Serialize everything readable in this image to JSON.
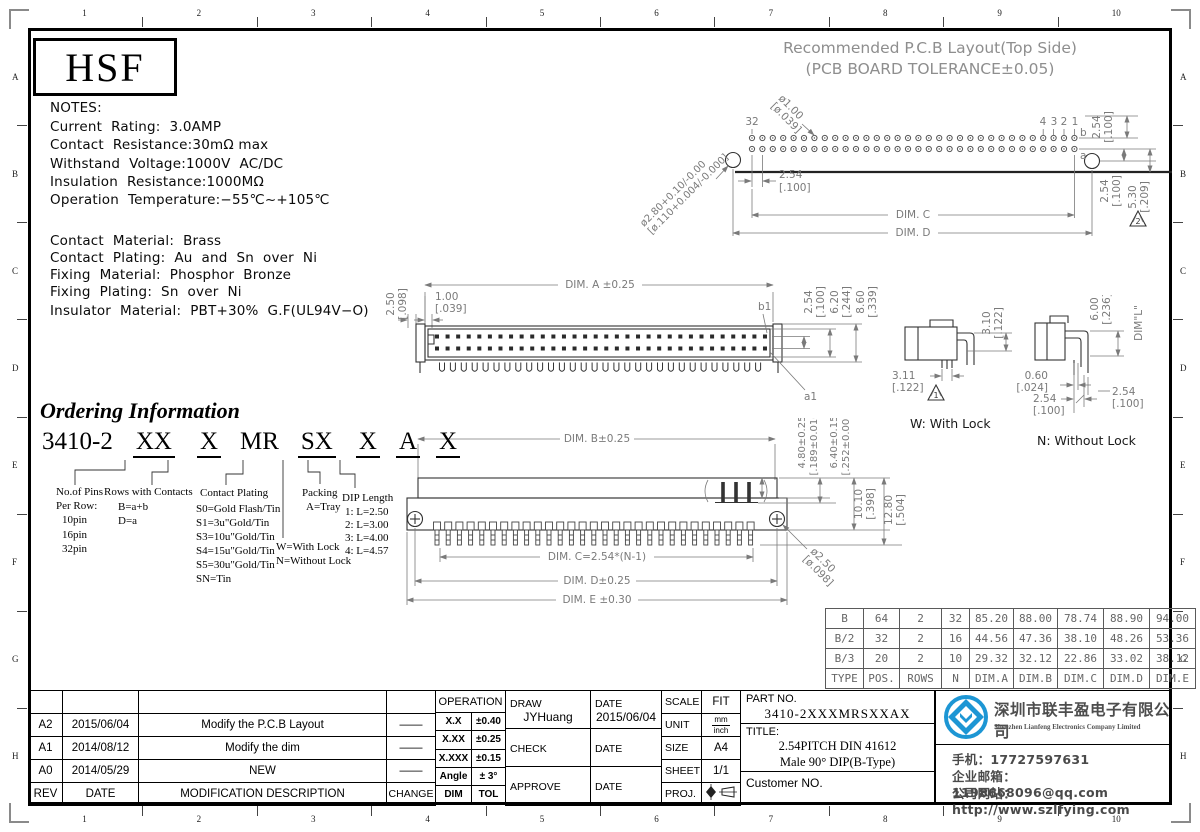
{
  "frame": {
    "cols": [
      "1",
      "2",
      "3",
      "4",
      "5",
      "6",
      "7",
      "8",
      "9",
      "10"
    ],
    "rows": [
      "A",
      "B",
      "C",
      "D",
      "E",
      "F",
      "G",
      "H"
    ]
  },
  "logo": {
    "text": "HSF"
  },
  "notes": {
    "title": "NOTES:",
    "lines": [
      "Current  Rating:  3.0AMP",
      "Contact  Resistance:30mΩ max",
      "Withstand  Voltage:1000V  AC/DC",
      "Insulation  Resistance:1000MΩ",
      "Operation  Temperature:−55℃~+105℃"
    ]
  },
  "materials": {
    "lines": [
      "Contact  Material:  Brass",
      "Contact  Plating:  Au  and  Sn  over  Ni",
      "Fixing  Material:  Phosphor  Bronze",
      "Fixing  Plating:  Sn  over  Ni",
      "Insulator  Material:  PBT+30%  G.F(UL94V−O)"
    ]
  },
  "pcb": {
    "title1": "Recommended  P.C.B  Layout(Top Side)",
    "title2": "(PCB  BOARD  TOLERANCE±0.05)",
    "pin32": "32",
    "pin4": "4",
    "pin3": "3",
    "pin2": "2",
    "pin1": "1",
    "row_b": "b",
    "row_a": "a",
    "hole1": "ø1.00",
    "hole1_in": "[ø.039]",
    "hole2": "ø2.80+0.10/-0.00",
    "hole2_in": "[ø.110+0.004/-0.000]",
    "pitch": "2.54",
    "pitch_in": "[.100]",
    "dim_c": "DIM. C",
    "dim_d": "DIM. D",
    "v1": "2.54",
    "v1_in": "[.100]",
    "v2": "2.54",
    "v2_in": "[.100]",
    "v3": "5.30",
    "v3_in": "[.209]",
    "tri": "2"
  },
  "front": {
    "d1": "2.50",
    "d1_in": "[.098]",
    "d2": "1.00",
    "d2_in": "[.039]",
    "dim_a": "DIM. A ±0.25",
    "b1": "b1",
    "a1": "a1",
    "v1": "2.54",
    "v1_in": "[.100]",
    "v2": "6.20",
    "v2_in": "[.244]",
    "v3": "8.60",
    "v3_in": "[.339]"
  },
  "lock_w": {
    "d1": "3.10",
    "d1_in": "[.122]",
    "d2": "3.11",
    "d2_in": "[.122]",
    "tri": "1",
    "caption": "W: With Lock"
  },
  "lock_n": {
    "d1": "6.00",
    "d1_in": "[.236]",
    "dim_l": "DIM\"L\"",
    "d2": "0.60",
    "d2_in": "[.024]",
    "d3": "2.54",
    "d3_in": "[.100]",
    "d4": "2.54",
    "d4_in": "[.100]",
    "caption": "N: Without Lock"
  },
  "bottom": {
    "dim_b": "DIM. B±0.25",
    "d1": "4.80±0.25",
    "d1_in": "[.189±0.010]",
    "d2": "6.40±0.15",
    "d2_in": "[.252±0.006]",
    "d3": "10.10",
    "d3_in": "[.398]",
    "d4": "12.80",
    "d4_in": "[.504]",
    "dim_c": "DIM. C=2.54*(N-1)",
    "dim_d": "DIM. D±0.25",
    "dim_e": "DIM. E ±0.30",
    "hole": "ø2.50",
    "hole_in": "[ø.098]"
  },
  "ordering": {
    "heading": "Ordering Information",
    "base": "3410-2",
    "codes": [
      "XX",
      "X",
      "MR",
      "SX",
      "X",
      "A",
      "X"
    ],
    "pins_title": "No.of Pins",
    "pins_sub": "Per Row:",
    "pins": [
      "10pin",
      "16pin",
      "32pin"
    ],
    "rows_title": "Rows with Contacts",
    "rows": [
      "B=a+b",
      "D=a"
    ],
    "plating_title": "Contact Plating",
    "plating": [
      "S0=Gold Flash/Tin",
      "S1=3u\"Gold/Tin",
      "S3=10u\"Gold/Tin",
      "S4=15u\"Gold/Tin",
      "S5=30u\"Gold/Tin",
      "SN=Tin"
    ],
    "lock": [
      "W=With Lock",
      "N=Without Lock"
    ],
    "packing_title": "Packing",
    "packing": "A=Tray",
    "dip_title": "DIP Length",
    "dip": [
      "1: L=2.50",
      "2: L=3.00",
      "3: L=4.00",
      "4: L=4.57"
    ]
  },
  "spec_table": {
    "rows": [
      [
        "B",
        "64",
        "2",
        "32",
        "85.20",
        "88.00",
        "78.74",
        "88.90",
        "94.00"
      ],
      [
        "B/2",
        "32",
        "2",
        "16",
        "44.56",
        "47.36",
        "38.10",
        "48.26",
        "53.36"
      ],
      [
        "B/3",
        "20",
        "2",
        "10",
        "29.32",
        "32.12",
        "22.86",
        "33.02",
        "38.12"
      ],
      [
        "TYPE",
        "POS.",
        "ROWS",
        "N",
        "DIM.A",
        "DIM.B",
        "DIM.C",
        "DIM.D",
        "DIM.E"
      ]
    ]
  },
  "rev_table": {
    "rows": [
      [
        "A2",
        "2015/06/04",
        "Modify the P.C.B Layout",
        "——"
      ],
      [
        "A1",
        "2014/08/12",
        "Modify the dim",
        "——"
      ],
      [
        "A0",
        "2014/05/29",
        "NEW",
        "——"
      ]
    ],
    "footer": [
      "REV",
      "DATE",
      "MODIFICATION DESCRIPTION",
      "CHANGE"
    ]
  },
  "tol_table": {
    "header": "OPERATION",
    "rows": [
      [
        "X.X",
        "±0.40"
      ],
      [
        "X.XX",
        "±0.25"
      ],
      [
        "X.XXX",
        "±0.15"
      ],
      [
        "Angle",
        "± 3°"
      ],
      [
        "DIM",
        "TOL"
      ]
    ]
  },
  "title_block": {
    "draw": "DRAW",
    "draw_name": "JYHuang",
    "date1": "DATE",
    "date1_val": "2015/06/04",
    "check": "CHECK",
    "date2": "DATE",
    "approve": "APPROVE",
    "date3": "DATE",
    "scale": "SCALE",
    "scale_val": "FIT",
    "unit": "UNIT",
    "unit_top": "mm",
    "unit_bottom": "inch",
    "size": "SIZE",
    "size_val": "A4",
    "sheet": "SHEET",
    "sheet_val": "1/1",
    "proj": "PROJ.",
    "part_label": "PART NO.",
    "part_no": "3410-2XXXMRSXXAX",
    "title_label": "TITLE:",
    "title1": "2.54PITCH DIN 41612",
    "title2": "Male 90° DIP(B-Type)",
    "customer": "Customer NO."
  },
  "company": {
    "name_cn": "深圳市联丰盈电子有限公司",
    "name_en": "Shenzhen Lianfeng Electronics Company Limited",
    "phone": "手机：17727597631",
    "email": "企业邮箱：1198668096@qq.com",
    "website": "公司网站：http://www.szlfying.com"
  }
}
